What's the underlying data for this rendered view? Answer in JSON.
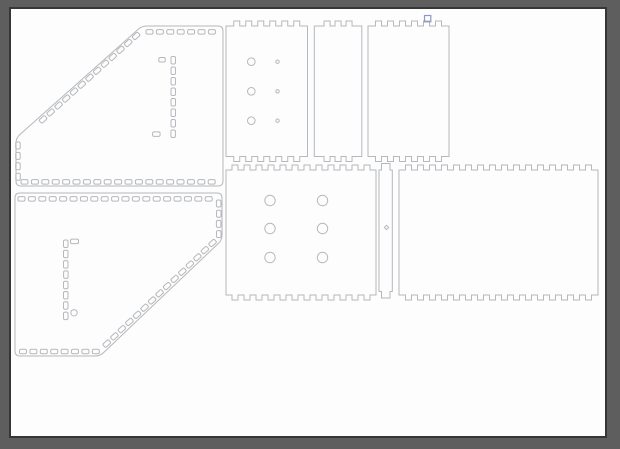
{
  "canvas": {
    "width": 620,
    "height": 449,
    "background_color": "#5e5e5e"
  },
  "page": {
    "x": 10,
    "y": 8,
    "width": 596,
    "height": 429,
    "fill": "#fdfdfd",
    "border_color": "#363636",
    "border_width": 2
  },
  "style": {
    "outline_color": "#b5b8bc",
    "outline_width": 1,
    "slot_corner_radius": 1.5,
    "selection_color": "#8e97c9"
  },
  "drawing": {
    "description": "laser-cut panel layout with finger joints, slots and holes",
    "panels": [
      {
        "name": "angled-panel-top-left",
        "shapes": [
          {
            "type": "outline",
            "r": 5,
            "pts": [
              [
                142,
                26
              ],
              [
                223,
                26
              ],
              [
                223,
                186
              ],
              [
                16,
                186
              ],
              [
                16,
                138
              ]
            ]
          },
          {
            "type": "slots",
            "cx": 149.5,
            "cy": 31.8,
            "n": 7,
            "dx": 10.4,
            "dy": 0,
            "w": 7,
            "h": 4.5,
            "a": 0
          },
          {
            "type": "slots",
            "cx": 136,
            "cy": 36,
            "n": 13,
            "dx": -7.75,
            "dy": 6.95,
            "w": 7.5,
            "h": 4.5,
            "a": -42
          },
          {
            "type": "slots",
            "cx": 18,
            "cy": 145.5,
            "n": 4,
            "dx": 0,
            "dy": 10.4,
            "w": 7,
            "h": 4.5,
            "a": 90
          },
          {
            "type": "slots",
            "cx": 24.5,
            "cy": 181.8,
            "n": 19,
            "dx": 10.4,
            "dy": 0,
            "w": 7,
            "h": 4.5,
            "a": 0
          },
          {
            "type": "slots",
            "cx": 173.2,
            "cy": 60.3,
            "n": 8,
            "dx": 0,
            "dy": 10.5,
            "w": 7.5,
            "h": 4.5,
            "a": 90
          },
          {
            "type": "slots",
            "cx": 162,
            "cy": 59.8,
            "n": 1,
            "dx": 0,
            "dy": 0,
            "w": 6.5,
            "h": 4.5,
            "a": 0
          },
          {
            "type": "slots",
            "cx": 156.3,
            "cy": 134.2,
            "n": 1,
            "dx": 0,
            "dy": 0,
            "w": 7.5,
            "h": 4.5,
            "a": 0
          }
        ]
      },
      {
        "name": "angled-panel-bottom-left",
        "shapes": [
          {
            "type": "outline",
            "r": 5,
            "pts": [
              [
                15,
                193
              ],
              [
                222,
                193
              ],
              [
                222,
                240
              ],
              [
                100,
                356
              ],
              [
                15,
                356
              ]
            ]
          },
          {
            "type": "slots",
            "cx": 21.5,
            "cy": 198.8,
            "n": 19,
            "dx": 10.4,
            "dy": 0,
            "w": 7,
            "h": 4.5,
            "a": 0
          },
          {
            "type": "slots",
            "cx": 218.7,
            "cy": 203.5,
            "n": 4,
            "dx": 0,
            "dy": 10.2,
            "w": 7,
            "h": 4.5,
            "a": 90
          },
          {
            "type": "slots",
            "cx": 212.5,
            "cy": 243,
            "n": 15,
            "dx": -7.55,
            "dy": 7.18,
            "w": 7.5,
            "h": 4.5,
            "a": -42
          },
          {
            "type": "slots",
            "cx": 23,
            "cy": 351.5,
            "n": 8,
            "dx": 10.4,
            "dy": 0,
            "w": 7,
            "h": 4.5,
            "a": 0
          },
          {
            "type": "slots",
            "cx": 65.8,
            "cy": 243.8,
            "n": 8,
            "dx": 0,
            "dy": 10.3,
            "w": 7.5,
            "h": 4.5,
            "a": 90
          },
          {
            "type": "slots",
            "cx": 74.5,
            "cy": 241.3,
            "n": 1,
            "dx": 0,
            "dy": 0,
            "w": 8,
            "h": 4.5,
            "a": 0
          },
          {
            "type": "circle",
            "cx": 74,
            "cy": 312.8,
            "r": 3.2
          }
        ]
      },
      {
        "name": "side-panel-small-holes",
        "shapes": [
          {
            "type": "cast",
            "x": 226,
            "y": 26,
            "w": 81.5,
            "h": 130.5,
            "t": 5,
            "p": 12,
            "tw": 6
          },
          {
            "type": "holes",
            "cx": 251.3,
            "cys": [
              61.7,
              91.3,
              120.7
            ],
            "r": 3.8
          },
          {
            "type": "holes",
            "cx": 277.5,
            "cys": [
              61.7,
              91.3,
              120.7
            ],
            "r": 1.7
          }
        ]
      },
      {
        "name": "narrow-side-panel",
        "shapes": [
          {
            "type": "cast",
            "x": 314.3,
            "y": 26,
            "w": 47.5,
            "h": 130.5,
            "t": 5,
            "p": 11,
            "tw": 6
          }
        ]
      },
      {
        "name": "side-panel-with-marker",
        "shapes": [
          {
            "type": "cast",
            "x": 368,
            "y": 26,
            "w": 81,
            "h": 130.5,
            "t": 5,
            "p": 12,
            "tw": 6
          },
          {
            "type": "marker",
            "x": 424.5,
            "y": 15.5,
            "w": 6.3,
            "h": 6.3,
            "name": "selection-marker"
          }
        ]
      },
      {
        "name": "base-panel-large-holes",
        "shapes": [
          {
            "type": "cast",
            "x": 226,
            "y": 170,
            "w": 150,
            "h": 125,
            "t": 5,
            "p": 12,
            "tw": 6
          },
          {
            "type": "holes",
            "cx": 270,
            "cys": [
              200.5,
              228.5,
              257.5
            ],
            "r": 5.2
          },
          {
            "type": "holes",
            "cx": 322.5,
            "cys": [
              200.5,
              228.5,
              257.5
            ],
            "r": 5.2
          }
        ]
      },
      {
        "name": "divider-strip",
        "shapes": [
          {
            "type": "path",
            "d": "M379,170 L381.5,170 L381.5,163.5 L390,163.5 L390,170 L392.3,170 L392.3,291.5 L390,291.5 L390,298 L381.5,298 L381.5,291.5 L379,291.5 Z"
          },
          {
            "type": "diamond",
            "cx": 386.5,
            "cy": 227.5,
            "s": 2.2
          }
        ]
      },
      {
        "name": "large-side-panel",
        "shapes": [
          {
            "type": "cast",
            "x": 399,
            "y": 170,
            "w": 199,
            "h": 125,
            "t": 5,
            "p": 12,
            "tw": 6
          }
        ]
      }
    ]
  }
}
